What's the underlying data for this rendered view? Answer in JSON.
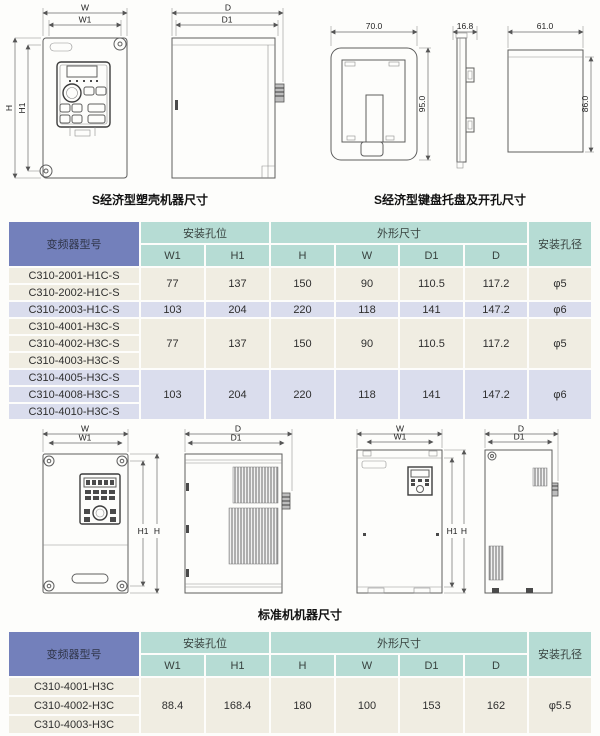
{
  "captions": {
    "economic": "S经济型塑壳机器尺寸",
    "keypad_tray": "S经济型键盘托盘及开孔尺寸",
    "standard": "标准机机器尺寸"
  },
  "drawings": {
    "economic_front": {
      "dims": {
        "w": "W",
        "w1": "W1",
        "h": "H",
        "h1": "H1"
      }
    },
    "economic_side": {
      "dims": {
        "d": "D",
        "d1": "D1"
      }
    },
    "keypad_tray": {
      "dims": {
        "width": "70.0",
        "height": "95.0",
        "depth": "16.8",
        "cut_width": "61.0",
        "cut_height": "86.0"
      }
    },
    "standard_small_front": {
      "dims": {
        "w": "W",
        "w1": "W1",
        "h": "H",
        "h1": "H1"
      }
    },
    "standard_small_side": {
      "dims": {
        "d": "D",
        "d1": "D1"
      }
    },
    "standard_large_front": {
      "dims": {
        "w": "W",
        "w1": "W1",
        "h": "H",
        "h1": "H1"
      }
    },
    "standard_large_side": {
      "dims": {
        "d": "D",
        "d1": "D1"
      }
    }
  },
  "table_s": {
    "headers": {
      "model": "变频器型号",
      "mount_group": "安装孔位",
      "outline_group": "外形尺寸",
      "hole_dia": "安装孔径",
      "w1": "W1",
      "h1": "H1",
      "h": "H",
      "w": "W",
      "d1": "D1",
      "d": "D"
    },
    "groups": [
      {
        "models": [
          "C310-2001-H1C-S",
          "C310-2002-H1C-S"
        ],
        "w1": "77",
        "h1": "137",
        "h": "150",
        "w": "90",
        "d1": "110.5",
        "d": "117.2",
        "hole": "φ5"
      },
      {
        "models": [
          "C310-2003-H1C-S"
        ],
        "w1": "103",
        "h1": "204",
        "h": "220",
        "w": "118",
        "d1": "141",
        "d": "147.2",
        "hole": "φ6"
      },
      {
        "models": [
          "C310-4001-H3C-S",
          "C310-4002-H3C-S",
          "C310-4003-H3C-S"
        ],
        "w1": "77",
        "h1": "137",
        "h": "150",
        "w": "90",
        "d1": "110.5",
        "d": "117.2",
        "hole": "φ5"
      },
      {
        "models": [
          "C310-4005-H3C-S",
          "C310-4008-H3C-S",
          "C310-4010-H3C-S"
        ],
        "w1": "103",
        "h1": "204",
        "h": "220",
        "w": "118",
        "d1": "141",
        "d": "147.2",
        "hole": "φ6"
      }
    ]
  },
  "table_std": {
    "headers": {
      "model": "变频器型号",
      "mount_group": "安装孔位",
      "outline_group": "外形尺寸",
      "hole_dia": "安装孔径",
      "w1": "W1",
      "h1": "H1",
      "h": "H",
      "w": "W",
      "d1": "D1",
      "d": "D"
    },
    "groups": [
      {
        "models": [
          "C310-4001-H3C",
          "C310-4002-H3C",
          "C310-4003-H3C"
        ],
        "w1": "88.4",
        "h1": "168.4",
        "h": "180",
        "w": "100",
        "d1": "153",
        "d": "162",
        "hole": "φ5.5"
      }
    ]
  },
  "colors": {
    "header_blue": "#7380bb",
    "header_teal": "#b6dcd4",
    "row_cream": "#f0ede2",
    "row_lavender": "#dadded"
  }
}
